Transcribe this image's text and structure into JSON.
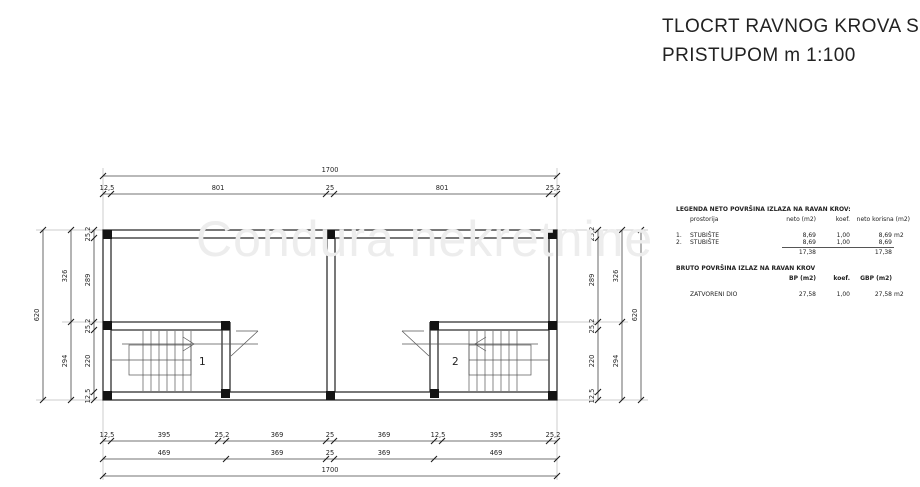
{
  "watermark": "Condura nekretnine",
  "title": {
    "line1": "TLOCRT  RAVNOG KROVA S",
    "line2": "PRISTUPOM  m 1:100"
  },
  "plan": {
    "room_labels": {
      "stair1": "1",
      "stair2": "2"
    }
  },
  "dims": {
    "top_total": "1700",
    "top_row": [
      "12,5",
      "801",
      "25",
      "801",
      "25,2"
    ],
    "bottom_row1": [
      "12,5",
      "395",
      "25,2",
      "369",
      "25",
      "369",
      "12,5",
      "395",
      "25,2"
    ],
    "bottom_row2": [
      "469",
      "369",
      "25",
      "369",
      "469"
    ],
    "bottom_total": "1700",
    "left_inner": [
      "25,2",
      "289",
      "25,2",
      "220",
      "12,5"
    ],
    "left_mid": [
      "326",
      "294"
    ],
    "left_total": "620",
    "right_inner": [
      "25,2",
      "289",
      "25,2",
      "220",
      "12,5"
    ],
    "right_mid": [
      "326",
      "294"
    ],
    "right_total": "620"
  },
  "legend": {
    "title": "LEGENDA NETO POVRŠINA IZLAZA NA RAVAN KROV:",
    "col_prostorija": "prostorija",
    "col_neto": "neto (m2)",
    "col_koef": "koef.",
    "col_korisna": "neto korisna (m2)",
    "rows": [
      {
        "num": "1.",
        "name": "STUBIŠTE",
        "neto": "8,69",
        "koef": "1,00",
        "korisna": "8,69",
        "unit": "m2"
      },
      {
        "num": "2.",
        "name": "STUBIŠTE",
        "neto": "8,69",
        "koef": "1,00",
        "korisna": "8,69",
        "unit": ""
      }
    ],
    "total_neto": "17,38",
    "total_korisna": "17,38",
    "bruto_title": "BRUTO POVRŠINA IZLAZ NA RAVAN KROV",
    "col_bp": "BP (m2)",
    "col_koef2": "koef.",
    "col_gbp": "GBP (m2)",
    "bruto_row": {
      "name": "ZATVORENI DIO",
      "bp": "27,58",
      "koef": "1,00",
      "gbp": "27,58",
      "unit": "m2"
    }
  },
  "colors": {
    "line": "#2f2f2f",
    "dim": "#444444",
    "watermark": "#ededed"
  }
}
